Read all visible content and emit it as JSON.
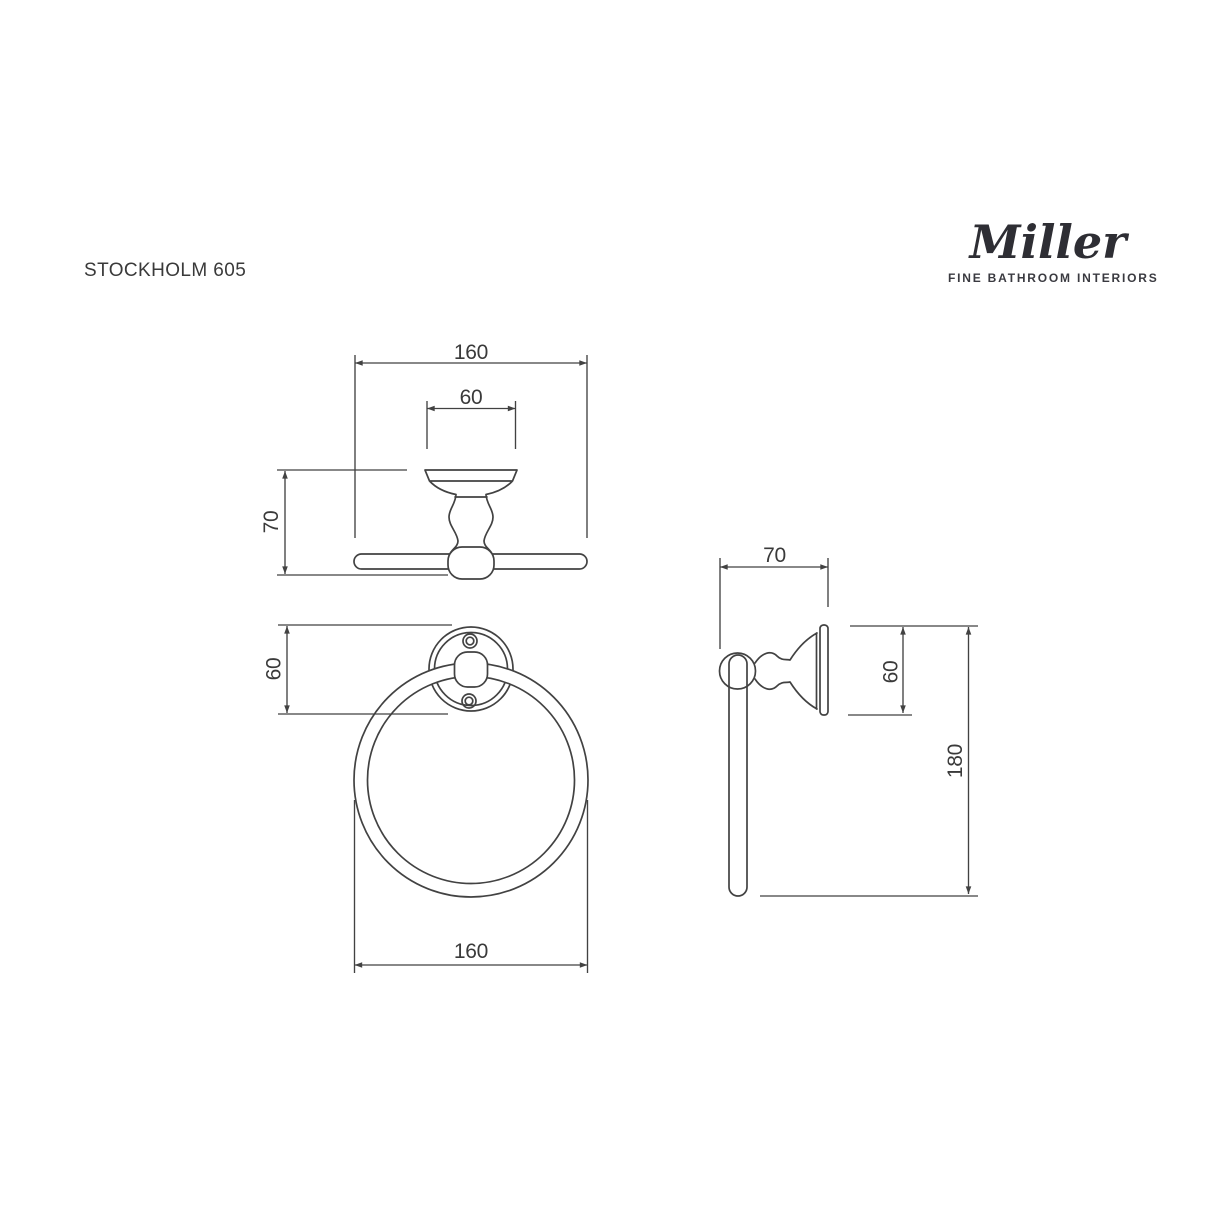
{
  "product": {
    "name": "STOCKHOLM 605"
  },
  "brand": {
    "logo_text": "Miller",
    "tagline": "FINE BATHROOM INTERIORS"
  },
  "colors": {
    "background": "#ffffff",
    "line": "#424242",
    "text": "#3a3a3a",
    "logo": "#2e2e34"
  },
  "views": {
    "top": {
      "overall_width_mm": "160",
      "backplate_width_mm": "60",
      "projection_mm": "70"
    },
    "front": {
      "rose_height_mm": "60",
      "ring_width_mm": "160"
    },
    "side": {
      "projection_mm": "70",
      "rose_height_mm": "60",
      "overall_height_mm": "180"
    }
  }
}
